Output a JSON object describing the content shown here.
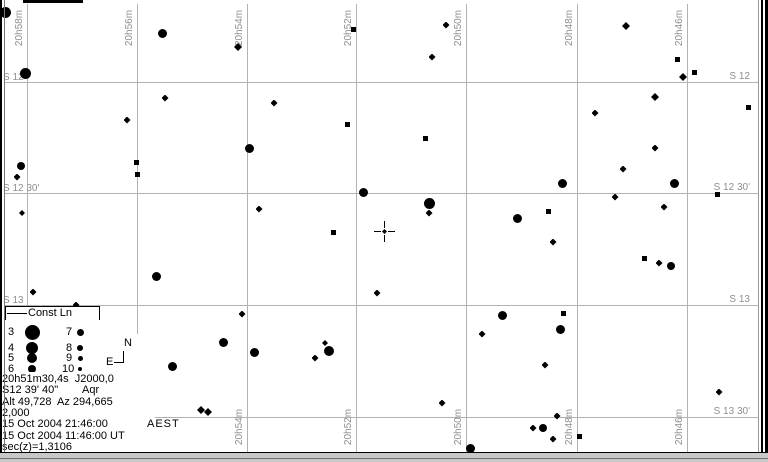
{
  "window": {
    "timezone_label": "AEST"
  },
  "chart": {
    "background": "#ffffff",
    "grid_color": "#b2b2b2",
    "axis_label_color": "#8f8f8f",
    "star_color": "#000000",
    "ra_gridlines": [
      {
        "label": "20h58m",
        "x": 27
      },
      {
        "label": "20h56m",
        "x": 137
      },
      {
        "label": "20h54m",
        "x": 247
      },
      {
        "label": "20h52m",
        "x": 356
      },
      {
        "label": "20h50m",
        "x": 466
      },
      {
        "label": "20h48m",
        "x": 577
      },
      {
        "label": "20h46m",
        "x": 687
      }
    ],
    "ra_bottom_labels": [
      "20h54m",
      "20h52m",
      "20h50m",
      "20h48m",
      "20h46m"
    ],
    "dec_gridlines": [
      {
        "label": "S 12",
        "y": 82
      },
      {
        "label": "S 12 30'",
        "y": 193
      },
      {
        "label": "S 13",
        "y": 305
      },
      {
        "label": "S 13 30'",
        "y": 417
      }
    ],
    "dec_left_labels": [
      "S 12",
      "S 12 30'",
      "S 13"
    ],
    "cursor": {
      "x": 384,
      "y": 231
    },
    "stars": [
      [
        5,
        12,
        11,
        "c"
      ],
      [
        162,
        33,
        9,
        "c"
      ],
      [
        238,
        47,
        8,
        "d"
      ],
      [
        353,
        29,
        5,
        "s"
      ],
      [
        446,
        25,
        7,
        "d"
      ],
      [
        432,
        57,
        7,
        "d"
      ],
      [
        626,
        26,
        8,
        "d"
      ],
      [
        677,
        59,
        5,
        "s"
      ],
      [
        683,
        77,
        8,
        "d"
      ],
      [
        694,
        72,
        5,
        "s"
      ],
      [
        655,
        97,
        8,
        "d"
      ],
      [
        748,
        107,
        5,
        "s"
      ],
      [
        25,
        73,
        11,
        "c"
      ],
      [
        21,
        166,
        8,
        "c"
      ],
      [
        17,
        177,
        7,
        "d"
      ],
      [
        22,
        213,
        6,
        "d"
      ],
      [
        33,
        292,
        7,
        "d"
      ],
      [
        76,
        305,
        7,
        "d"
      ],
      [
        165,
        98,
        7,
        "d"
      ],
      [
        127,
        120,
        7,
        "d"
      ],
      [
        249,
        148,
        9,
        "c"
      ],
      [
        136,
        162,
        5,
        "s"
      ],
      [
        137,
        174,
        5,
        "s"
      ],
      [
        259,
        209,
        7,
        "d"
      ],
      [
        156,
        276,
        9,
        "c"
      ],
      [
        274,
        103,
        7,
        "d"
      ],
      [
        347,
        124,
        5,
        "s"
      ],
      [
        425,
        138,
        5,
        "s"
      ],
      [
        363,
        192,
        9,
        "c"
      ],
      [
        429,
        203,
        11,
        "c"
      ],
      [
        429,
        213,
        7,
        "d"
      ],
      [
        333,
        232,
        5,
        "s"
      ],
      [
        377,
        293,
        7,
        "d"
      ],
      [
        595,
        113,
        7,
        "d"
      ],
      [
        655,
        148,
        7,
        "d"
      ],
      [
        623,
        169,
        7,
        "d"
      ],
      [
        562,
        183,
        9,
        "c"
      ],
      [
        674,
        183,
        9,
        "c"
      ],
      [
        615,
        197,
        7,
        "d"
      ],
      [
        664,
        207,
        7,
        "d"
      ],
      [
        717,
        194,
        5,
        "s"
      ],
      [
        517,
        218,
        9,
        "c"
      ],
      [
        548,
        211,
        5,
        "s"
      ],
      [
        553,
        242,
        7,
        "d"
      ],
      [
        644,
        258,
        5,
        "s"
      ],
      [
        659,
        263,
        7,
        "d"
      ],
      [
        671,
        266,
        8,
        "c"
      ],
      [
        242,
        314,
        7,
        "d"
      ],
      [
        223,
        342,
        9,
        "c"
      ],
      [
        254,
        352,
        9,
        "c"
      ],
      [
        172,
        366,
        9,
        "c"
      ],
      [
        325,
        343,
        6,
        "d"
      ],
      [
        329,
        351,
        10,
        "c"
      ],
      [
        315,
        358,
        7,
        "d"
      ],
      [
        502,
        315,
        9,
        "c"
      ],
      [
        482,
        334,
        7,
        "d"
      ],
      [
        442,
        403,
        7,
        "d"
      ],
      [
        563,
        313,
        5,
        "s"
      ],
      [
        560,
        329,
        9,
        "c"
      ],
      [
        545,
        365,
        7,
        "d"
      ],
      [
        719,
        392,
        7,
        "d"
      ],
      [
        201,
        410,
        8,
        "d"
      ],
      [
        208,
        412,
        8,
        "d"
      ],
      [
        470,
        448,
        9,
        "c"
      ],
      [
        533,
        428,
        7,
        "d"
      ],
      [
        543,
        428,
        8,
        "c"
      ],
      [
        553,
        439,
        7,
        "d"
      ],
      [
        557,
        416,
        7,
        "d"
      ],
      [
        579,
        436,
        5,
        "s"
      ]
    ]
  },
  "legend": {
    "title": "Const Ln",
    "rows": [
      {
        "mag_left": "3",
        "size_left": 15,
        "mag_right": "7",
        "size_right": 7,
        "y": 12
      },
      {
        "mag_left": "4",
        "size_left": 12,
        "mag_right": "8",
        "size_right": 6,
        "y": 28
      },
      {
        "mag_left": "5",
        "size_left": 10,
        "mag_right": "9",
        "size_right": 5,
        "y": 38
      },
      {
        "mag_left": "6",
        "size_left": 8,
        "mag_right": "10",
        "size_right": 4,
        "y": 49
      }
    ]
  },
  "compass": {
    "north": "N",
    "east": "E"
  },
  "info": {
    "lines": [
      "20h51m30,4s  J2000,0",
      "S12 39' 40\"        Aqr",
      "Alt 49,728  Az 294,665",
      "2,000",
      "15 Oct 2004 21:46:00",
      "15 Oct 2004 11:46:00 UT",
      "sec(z)=1,3106"
    ]
  }
}
